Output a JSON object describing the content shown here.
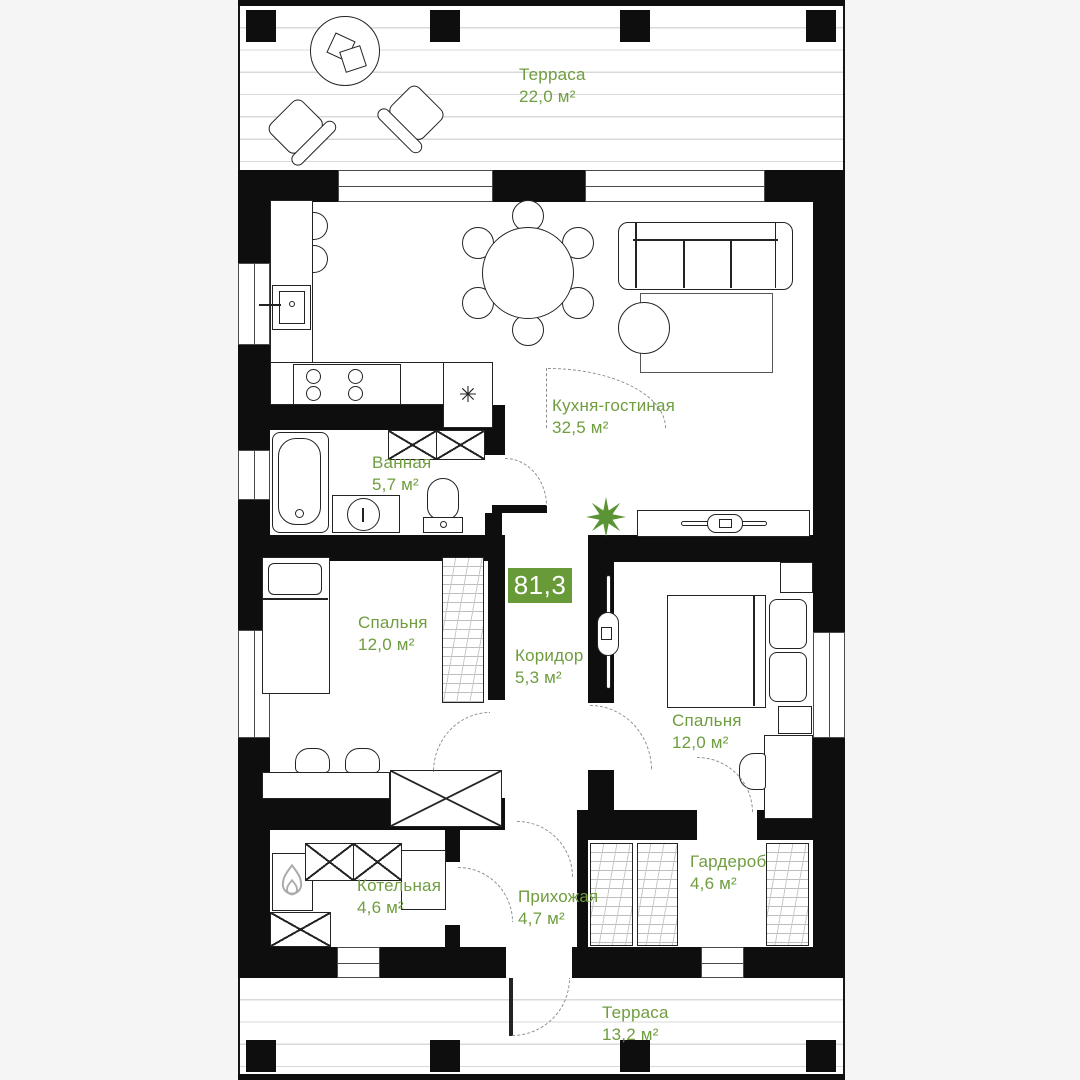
{
  "plan": {
    "title": "floor-plan",
    "total_area_badge": "81,3",
    "rooms": [
      {
        "id": "terrace-top",
        "name": "Терраса",
        "area": "22,0 м²"
      },
      {
        "id": "kitchen-living",
        "name": "Кухня-гостиная",
        "area": "32,5 м²"
      },
      {
        "id": "bathroom",
        "name": "Ванная",
        "area": "5,7 м²"
      },
      {
        "id": "corridor",
        "name": "Коридор",
        "area": "5,3 м²"
      },
      {
        "id": "bedroom-left",
        "name": "Спальня",
        "area": "12,0 м²"
      },
      {
        "id": "bedroom-right",
        "name": "Спальня",
        "area": "12,0 м²"
      },
      {
        "id": "boiler-room",
        "name": "Котельная",
        "area": "4,6 м²"
      },
      {
        "id": "hallway",
        "name": "Прихожая",
        "area": "4,7 м²"
      },
      {
        "id": "wardrobe",
        "name": "Гардероб",
        "area": "4,6 м²"
      },
      {
        "id": "terrace-bottom",
        "name": "Терраса",
        "area": "13,2 м²"
      }
    ],
    "icons": {
      "fridge_symbol": "✳"
    },
    "colors": {
      "accent_green": "#6f9d3f",
      "badge_green": "#689a37",
      "wall_black": "#0e0e0e",
      "background": "#f4f5f4",
      "deck_line": "#d9d9d9",
      "hatch_gray": "#bdbdbd"
    }
  }
}
